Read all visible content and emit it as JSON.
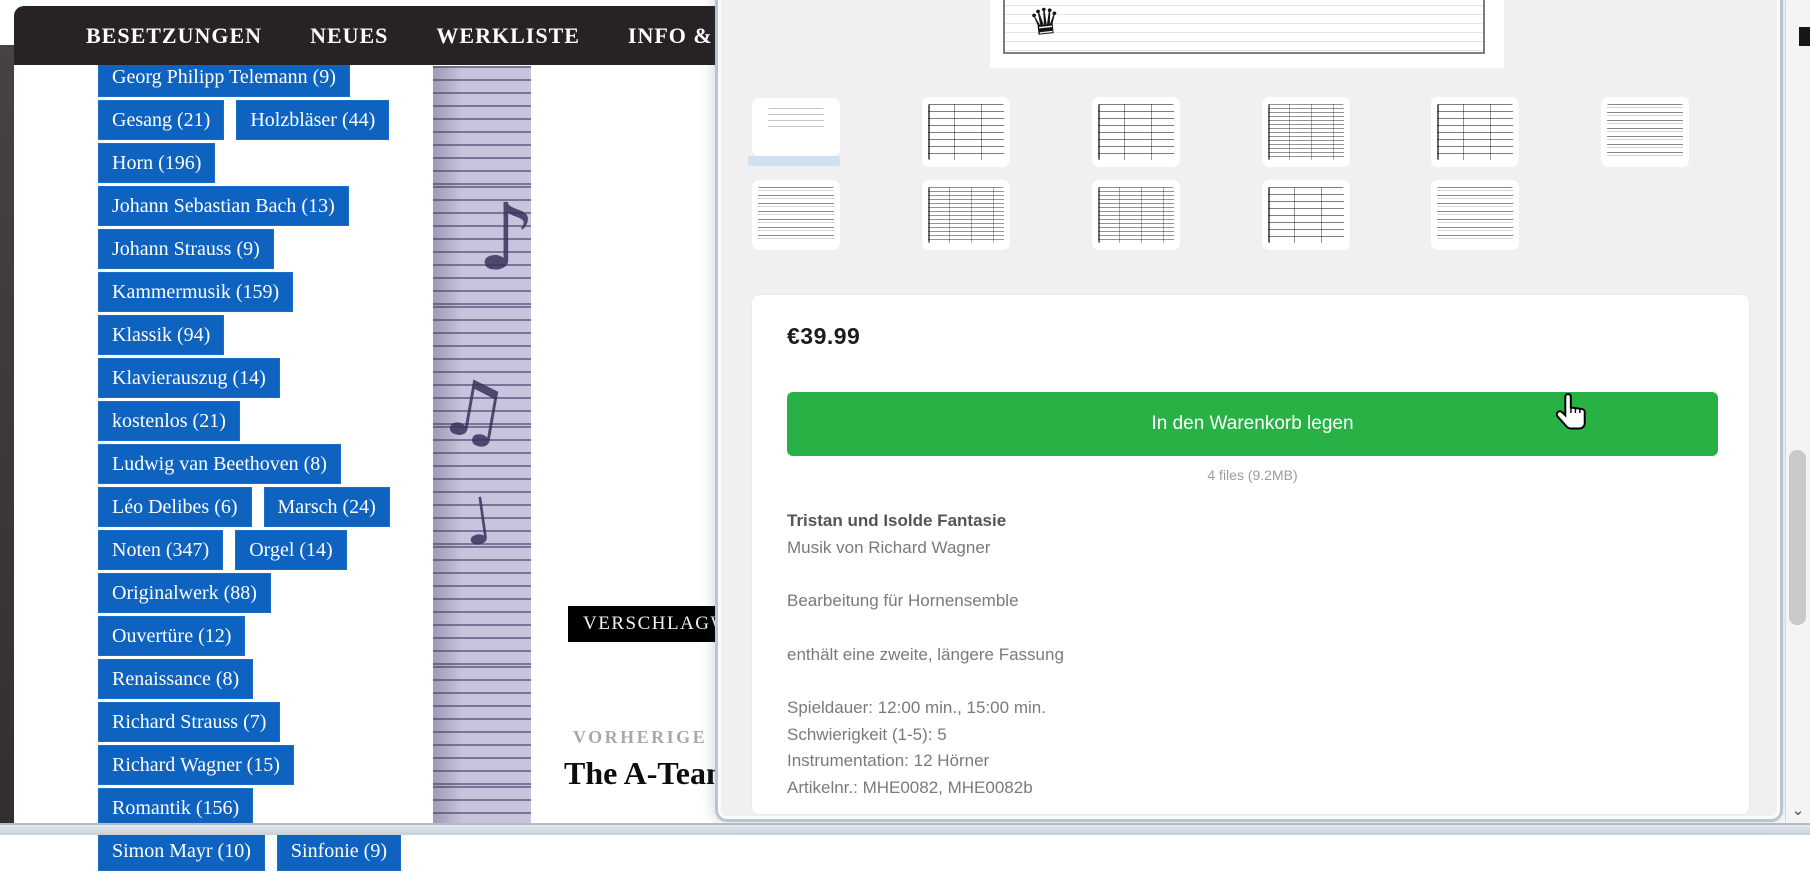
{
  "nav": {
    "bg_color": "#272324",
    "items": [
      {
        "label": "BESETZUNGEN"
      },
      {
        "label": "NEUES"
      },
      {
        "label": "WERKLISTE"
      },
      {
        "label": "INFO &"
      }
    ]
  },
  "sidebar": {
    "tag_color": "#0e63c0",
    "tag_rows": [
      [
        "Georg Philipp Telemann (9)"
      ],
      [
        "Gesang (21)",
        "Holzbläser (44)"
      ],
      [
        "Horn (196)"
      ],
      [
        "Johann Sebastian Bach (13)"
      ],
      [
        "Johann Strauss (9)"
      ],
      [
        "Kammermusik (159)"
      ],
      [
        "Klassik (94)"
      ],
      [
        "Klavierauszug (14)"
      ],
      [
        "kostenlos (21)"
      ],
      [
        "Ludwig van Beethoven (8)"
      ],
      [
        "Léo Delibes (6)",
        "Marsch (24)"
      ],
      [
        "Noten (347)",
        "Orgel (14)"
      ],
      [
        "Originalwerk (88)"
      ],
      [
        "Ouvertüre (12)"
      ],
      [
        "Renaissance (8)"
      ],
      [
        "Richard Strauss (7)"
      ],
      [
        "Richard Wagner (15)"
      ],
      [
        "Romantik (156)"
      ],
      [
        "Simon Mayr (10)",
        "Sinfonie (9)"
      ]
    ]
  },
  "content": {
    "tag_header_label": "VERSCHLAGW",
    "previous_post_label": "VORHERIGE",
    "previous_post_title": "The A-Tean"
  },
  "modal": {
    "price": "€39.99",
    "add_to_cart_label": "In den Warenkorb legen",
    "button_color": "#28b245",
    "files_info": "4 files (9.2MB)",
    "details": {
      "title": "Tristan und Isolde Fantasie",
      "line_composer": "Musik von Richard Wagner",
      "line_arrangement": "Bearbeitung für Hornensemble",
      "line_note": "enthält eine zweite, längere Fassung",
      "specs": [
        "Spieldauer: 12:00 min., 15:00 min.",
        "Schwierigkeit (1-5): 5",
        "Instrumentation: 12 Hörner",
        "Artikelnr.: MHE0082, MHE0082b"
      ]
    },
    "thumbnails": {
      "row1_count": 6,
      "row2_count": 5,
      "selected_index": 0
    }
  },
  "background_notes": [
    "♪",
    "♫",
    "♩"
  ]
}
